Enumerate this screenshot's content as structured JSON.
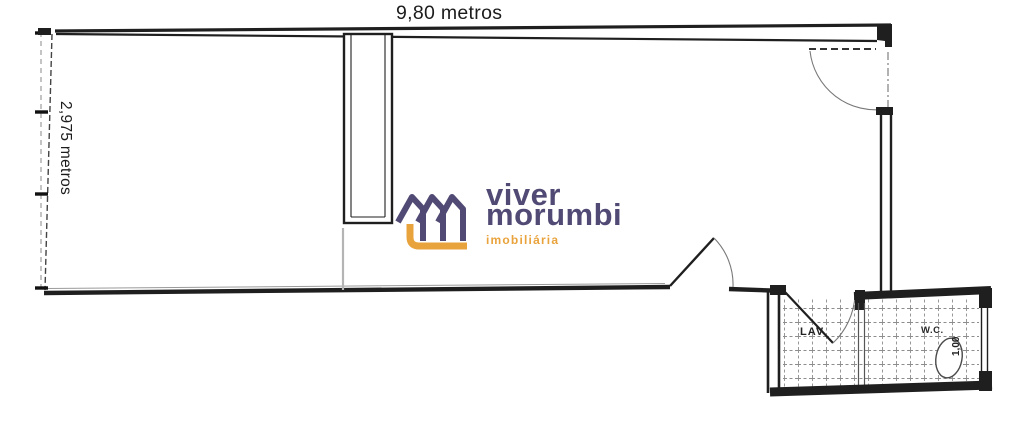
{
  "floor_plan": {
    "dimensions": {
      "width_label": "9,80 metros",
      "depth_label": "2,975 metros",
      "wc_width_label": "1,00"
    },
    "rooms": {
      "laundry_label": "LAV",
      "wc_label": "W.C."
    }
  },
  "watermark": {
    "brand_line1": "viver",
    "brand_line2": "morumbi",
    "tagline": "imobiliária"
  },
  "colors": {
    "ink": "#1f1f1f",
    "arc-gray": "#787878",
    "tile-line": "#8d8d8d",
    "logo-purple": "#514a74",
    "logo-orange": "#e9a33c"
  }
}
